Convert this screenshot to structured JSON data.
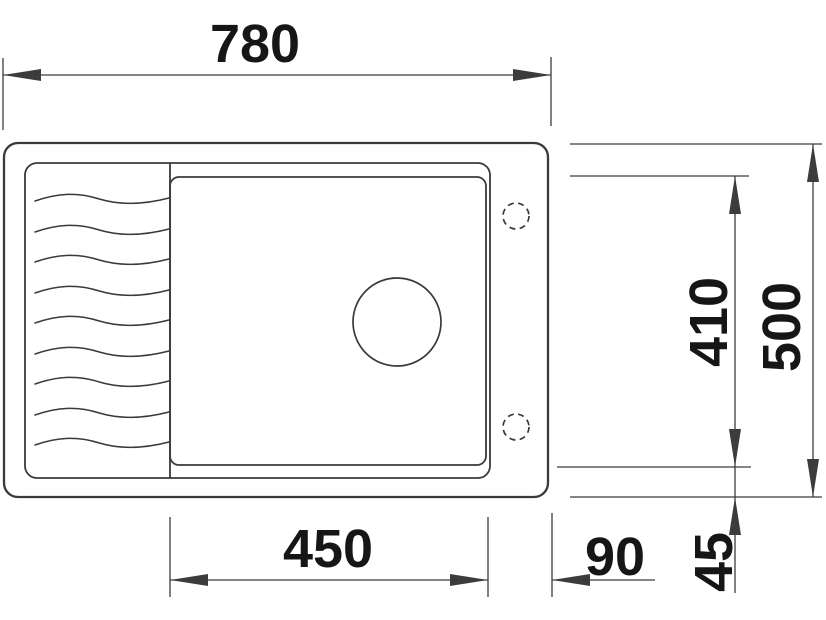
{
  "drawing_title": "sink-top-view-dimensioned-drawing",
  "colors": {
    "outline": "#3a3a3a",
    "dim_line": "#3c3c3c",
    "label_text": "#161616",
    "background": "#ffffff"
  },
  "style": {
    "label_font_size": 54,
    "outline_stroke": 2.3,
    "inner_stroke": 1.8,
    "wave_stroke": 1.5,
    "dim_stroke": 1.3,
    "arrow_len": 38,
    "arrow_half_w": 6
  },
  "sink": {
    "outer_rect": {
      "x": 4,
      "y": 143,
      "w": 544,
      "h": 354,
      "rx": 14
    },
    "recess_rect": {
      "x": 25,
      "y": 163,
      "w": 465,
      "h": 315,
      "rx": 12
    },
    "divider_line": {
      "x": 170,
      "y1": 163,
      "y2": 478
    },
    "basin_rect": {
      "x": 170,
      "y": 177,
      "w": 316,
      "h": 288,
      "rx": 9
    },
    "drain_hole": {
      "cx": 397,
      "cy": 322,
      "r": 44
    },
    "tap_holes": [
      {
        "cx": 516,
        "cy": 216,
        "r": 13
      },
      {
        "cx": 516,
        "cy": 427,
        "r": 13
      }
    ],
    "waves": {
      "x1": 35,
      "x2": 169,
      "ys": [
        199,
        230,
        260,
        291,
        321,
        352,
        382,
        413,
        443
      ]
    }
  },
  "dimensions": [
    {
      "label": "780",
      "value_mm": 780,
      "role": "overall-width",
      "ext": [
        [
          3,
          58,
          3,
          130
        ],
        [
          551,
          57,
          551,
          126
        ]
      ],
      "lines": [
        [
          3,
          75,
          551,
          75
        ]
      ],
      "arrows": [
        [
          3,
          75,
          "left"
        ],
        [
          551,
          75,
          "right"
        ]
      ],
      "text": {
        "x": 255,
        "y": 62,
        "rotate": 0
      }
    },
    {
      "label": "500",
      "value_mm": 500,
      "role": "overall-depth",
      "ext": [
        [
          570,
          144,
          822,
          144
        ],
        [
          570,
          497,
          822,
          497
        ]
      ],
      "lines": [
        [
          813,
          144,
          813,
          497
        ]
      ],
      "arrows": [
        [
          813,
          144,
          "up"
        ],
        [
          813,
          497,
          "down"
        ]
      ],
      "text": {
        "x": 800,
        "y": 327,
        "rotate": -90
      }
    },
    {
      "label": "410",
      "value_mm": 410,
      "role": "bowl-depth",
      "ext": [
        [
          570,
          176,
          749,
          176
        ],
        [
          557,
          467,
          751,
          467
        ]
      ],
      "lines": [
        [
          735,
          176,
          735,
          467
        ]
      ],
      "arrows": [
        [
          735,
          176,
          "up"
        ],
        [
          735,
          467,
          "down"
        ]
      ],
      "text": {
        "x": 727,
        "y": 322,
        "rotate": -90
      }
    },
    {
      "label": "450",
      "value_mm": 450,
      "role": "bowl-width",
      "ext": [
        [
          170,
          517,
          170,
          597
        ],
        [
          488,
          517,
          488,
          597
        ]
      ],
      "lines": [
        [
          170,
          580,
          488,
          580
        ]
      ],
      "arrows": [
        [
          170,
          580,
          "left"
        ],
        [
          488,
          580,
          "right"
        ]
      ],
      "text": {
        "x": 328,
        "y": 567,
        "rotate": 0
      }
    },
    {
      "label": "90",
      "value_mm": 90,
      "role": "bowl-to-edge-offset",
      "ext": [
        [
          552,
          513,
          552,
          597
        ]
      ],
      "lines": [
        [
          552,
          580,
          655,
          580
        ]
      ],
      "arrows": [
        [
          552,
          580,
          "left"
        ]
      ],
      "text": {
        "x": 615,
        "y": 575,
        "rotate": 0
      }
    },
    {
      "label": "45",
      "value_mm": 45,
      "role": "bowl-to-back-offset",
      "ext": [],
      "lines": [
        [
          735,
          467,
          735,
          593
        ]
      ],
      "arrows": [
        [
          735,
          497,
          "up"
        ]
      ],
      "text": {
        "x": 732,
        "y": 562,
        "rotate": -90
      }
    }
  ]
}
